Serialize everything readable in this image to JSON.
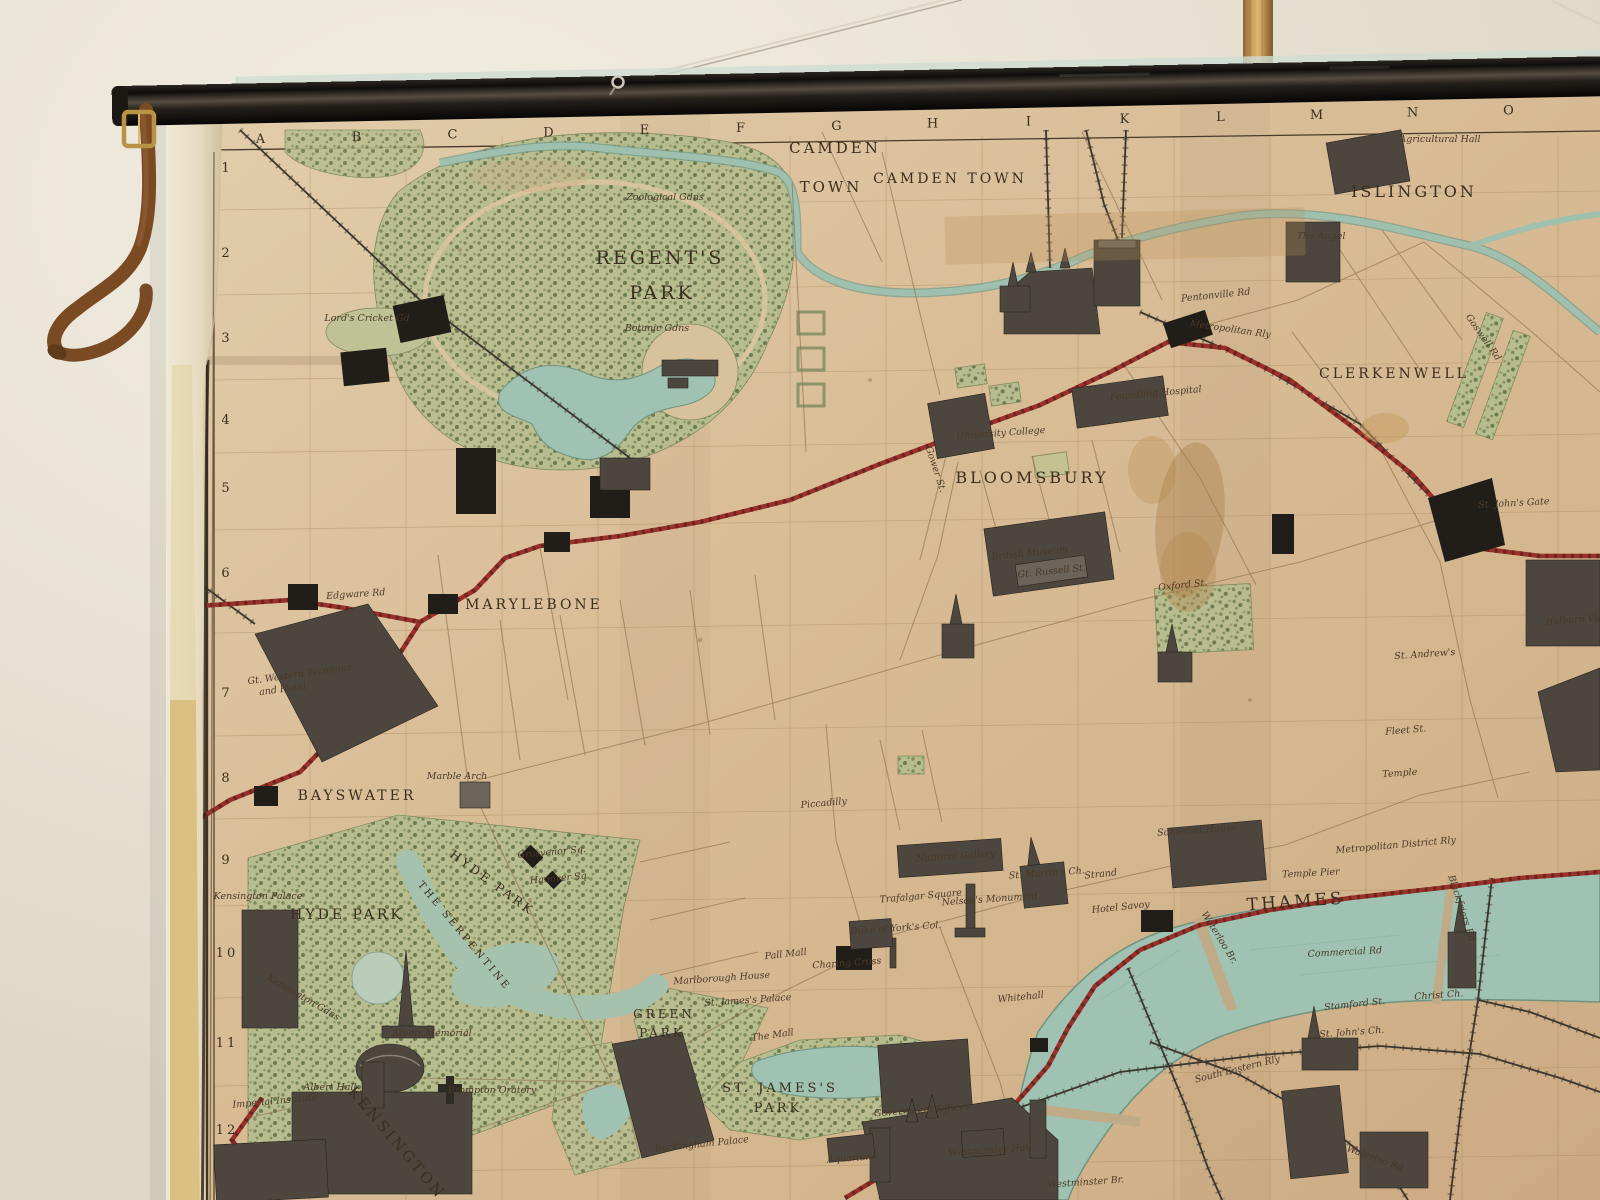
{
  "scene": {
    "description": "Photograph of an antique pictorial wall map of central London hanging from a black roller rod on a plain wall, with a wooden pole and hanging cords at top and a leather strap at the left end",
    "wall_color": "#e9e4d6",
    "roller_color": "#16120f",
    "strap_color": "#7a4a22",
    "pole_color": "#caa05c",
    "paper_color": "#d7bc97",
    "park_color": "#b7bd8f",
    "water_color": "#9fc2b2",
    "railway_red": "#9e2f28",
    "ink_color": "#3a2e1e"
  },
  "map": {
    "grid_letters": [
      "A",
      "B",
      "C",
      "D",
      "E",
      "F",
      "G",
      "H",
      "I",
      "K",
      "L",
      "M",
      "N",
      "O"
    ],
    "grid_rows": [
      "1",
      "2",
      "3",
      "4",
      "5",
      "6",
      "7",
      "8",
      "9",
      "10",
      "11",
      "12"
    ],
    "grid_row_y": [
      172,
      257,
      342,
      424,
      492,
      577,
      697,
      782,
      864,
      957,
      1047,
      1134
    ],
    "labels": [
      {
        "id": "camden-town-1a",
        "t": "CAMDEN",
        "x": 835,
        "y": 153,
        "k": "d",
        "s": 15,
        "ls": 4
      },
      {
        "id": "camden-town-1b",
        "t": "TOWN",
        "x": 831,
        "y": 192,
        "k": "d",
        "s": 15,
        "ls": 4
      },
      {
        "id": "camden-town-2",
        "t": "CAMDEN TOWN",
        "x": 950,
        "y": 183,
        "k": "d",
        "s": 14,
        "ls": 3
      },
      {
        "id": "islington",
        "t": "ISLINGTON",
        "x": 1414,
        "y": 197,
        "k": "d",
        "s": 16,
        "ls": 4
      },
      {
        "id": "clerkenwell",
        "t": "CLERKENWELL",
        "x": 1394,
        "y": 378,
        "k": "d",
        "s": 14,
        "ls": 4
      },
      {
        "id": "regents-park-1",
        "t": "REGENT'S",
        "x": 660,
        "y": 264,
        "k": "d",
        "s": 19,
        "ls": 6
      },
      {
        "id": "regents-park-2",
        "t": "PARK",
        "x": 662,
        "y": 299,
        "k": "d",
        "s": 19,
        "ls": 6
      },
      {
        "id": "bloomsbury",
        "t": "BLOOMSBURY",
        "x": 1032,
        "y": 483,
        "k": "d",
        "s": 16,
        "ls": 3
      },
      {
        "id": "marylebone",
        "t": "MARYLEBONE",
        "x": 534,
        "y": 609,
        "k": "d",
        "s": 14,
        "ls": 4
      },
      {
        "id": "bayswater",
        "t": "BAYSWATER",
        "x": 357,
        "y": 800,
        "k": "d",
        "s": 14,
        "ls": 3
      },
      {
        "id": "hyde-park-1",
        "t": "HYDE PARK",
        "x": 347,
        "y": 919,
        "k": "d",
        "s": 14,
        "ls": 3
      },
      {
        "id": "hyde-park-2",
        "t": "HYDE PARK",
        "x": 490,
        "y": 886,
        "k": "d",
        "s": 12,
        "r": 36,
        "ls": 2
      },
      {
        "id": "the-serpentine",
        "t": "THE SERPENTINE",
        "x": 462,
        "y": 938,
        "k": "d",
        "s": 10,
        "r": 50,
        "ls": 2
      },
      {
        "id": "green-park-1",
        "t": "GREEN",
        "x": 664,
        "y": 1018,
        "k": "d",
        "s": 12,
        "ls": 2
      },
      {
        "id": "green-park-2",
        "t": "PARK",
        "x": 662,
        "y": 1037,
        "k": "d",
        "s": 12,
        "ls": 2
      },
      {
        "id": "st-jamess-park-1",
        "t": "ST. JAMES'S",
        "x": 780,
        "y": 1092,
        "k": "d",
        "s": 13,
        "ls": 2
      },
      {
        "id": "st-jamess-park-2",
        "t": "PARK",
        "x": 778,
        "y": 1112,
        "k": "d",
        "s": 13,
        "ls": 2
      },
      {
        "id": "thames",
        "t": "THAMES",
        "x": 1296,
        "y": 907,
        "k": "d",
        "s": 17,
        "r": -4,
        "ls": 7
      },
      {
        "id": "kensington",
        "t": "KENSINGTON",
        "x": 393,
        "y": 1146,
        "k": "d",
        "s": 15,
        "r": 50,
        "ls": 3
      },
      {
        "id": "zoological-gdns",
        "t": "Zoological Gdns",
        "x": 665,
        "y": 200,
        "k": "i"
      },
      {
        "id": "botanic-gdns",
        "t": "Botanic Gdns",
        "x": 657,
        "y": 331,
        "k": "i"
      },
      {
        "id": "lords-cricket",
        "t": "Lord's Cricket Gd",
        "x": 367,
        "y": 321,
        "k": "i"
      },
      {
        "id": "agricultural-hall",
        "t": "Agricultural Hall",
        "x": 1440,
        "y": 142,
        "k": "i"
      },
      {
        "id": "the-angel",
        "t": "The Angel",
        "x": 1321,
        "y": 239,
        "k": "i"
      },
      {
        "id": "pentonville-rd",
        "t": "Pentonville Rd",
        "x": 1216,
        "y": 298,
        "k": "i",
        "r": -6
      },
      {
        "id": "metropolitan-rly",
        "t": "Metropolitan Rly",
        "x": 1230,
        "y": 332,
        "k": "i",
        "r": 8
      },
      {
        "id": "foundling-hospital",
        "t": "Foundling Hospital",
        "x": 1156,
        "y": 396,
        "k": "i",
        "r": -5
      },
      {
        "id": "university-college",
        "t": "University College",
        "x": 1001,
        "y": 436,
        "k": "i",
        "r": -4
      },
      {
        "id": "british-museum",
        "t": "British Museum",
        "x": 1030,
        "y": 556,
        "k": "i",
        "r": -6
      },
      {
        "id": "gt-russell-st",
        "t": "Gt. Russell St.",
        "x": 1052,
        "y": 574,
        "k": "i",
        "r": -6
      },
      {
        "id": "gt-western-terminus",
        "t": "Gt. Western Terminus",
        "x": 300,
        "y": 677,
        "k": "i",
        "r": -8
      },
      {
        "id": "gt-western-hotel",
        "t": "and Hotel",
        "x": 283,
        "y": 692,
        "k": "i",
        "r": -8
      },
      {
        "id": "edgware-rd",
        "t": "Edgware Rd",
        "x": 356,
        "y": 597,
        "k": "i",
        "r": -4
      },
      {
        "id": "marble-arch",
        "t": "Marble Arch",
        "x": 457,
        "y": 779,
        "k": "i"
      },
      {
        "id": "grosvenor-sq",
        "t": "Grosvenor Sq.",
        "x": 552,
        "y": 855,
        "k": "i",
        "r": -5
      },
      {
        "id": "hanover-sq",
        "t": "Hanover Sq.",
        "x": 560,
        "y": 881,
        "k": "i",
        "r": -5
      },
      {
        "id": "piccadilly",
        "t": "Piccadilly",
        "x": 824,
        "y": 806,
        "k": "i",
        "r": -5
      },
      {
        "id": "kensington-gdns",
        "t": "Kensington Gdns",
        "x": 302,
        "y": 1000,
        "k": "i",
        "r": 30
      },
      {
        "id": "kensington-palace",
        "t": "Kensington Palace",
        "x": 258,
        "y": 899,
        "k": "i"
      },
      {
        "id": "albert-memorial",
        "t": "Albert Memorial",
        "x": 432,
        "y": 1036,
        "k": "i"
      },
      {
        "id": "albert-hall",
        "t": "Albert Hall",
        "x": 330,
        "y": 1090,
        "k": "i"
      },
      {
        "id": "imperial-institute",
        "t": "Imperial Institute",
        "x": 275,
        "y": 1104,
        "k": "i",
        "r": -5
      },
      {
        "id": "brompton-oratory",
        "t": "Brompton Oratory",
        "x": 492,
        "y": 1093,
        "k": "i"
      },
      {
        "id": "buckingham-palace",
        "t": "Buckingham Palace",
        "x": 702,
        "y": 1147,
        "k": "i",
        "r": -6
      },
      {
        "id": "national-gallery",
        "t": "National Gallery",
        "x": 956,
        "y": 859,
        "k": "i",
        "r": -4
      },
      {
        "id": "trafalgar-square",
        "t": "Trafalgar Square",
        "x": 921,
        "y": 899,
        "k": "i",
        "r": -5
      },
      {
        "id": "nelsons-monument",
        "t": "Nelson's Monument",
        "x": 990,
        "y": 902,
        "k": "i",
        "r": -4
      },
      {
        "id": "st-martins-ch",
        "t": "St. Martin's Ch.",
        "x": 1047,
        "y": 876,
        "k": "i",
        "r": -4
      },
      {
        "id": "duke-of-yorks-col",
        "t": "Duke of York's Col.",
        "x": 896,
        "y": 931,
        "k": "i",
        "r": -4
      },
      {
        "id": "pall-mall",
        "t": "Pall Mall",
        "x": 786,
        "y": 957,
        "k": "i",
        "r": -6
      },
      {
        "id": "marlborough-house",
        "t": "Marlborough House",
        "x": 722,
        "y": 981,
        "k": "i",
        "r": -4
      },
      {
        "id": "st-jamess-palace",
        "t": "St. James's Palace",
        "x": 748,
        "y": 1003,
        "k": "i",
        "r": -4
      },
      {
        "id": "the-mall",
        "t": "The Mall",
        "x": 773,
        "y": 1038,
        "k": "i",
        "r": -8
      },
      {
        "id": "charing-cross",
        "t": "Charing Cross",
        "x": 847,
        "y": 966,
        "k": "i",
        "r": -4
      },
      {
        "id": "whitehall",
        "t": "Whitehall",
        "x": 1021,
        "y": 1000,
        "k": "i",
        "r": -6
      },
      {
        "id": "strand",
        "t": "Strand",
        "x": 1101,
        "y": 877,
        "k": "i",
        "r": -6
      },
      {
        "id": "hotel-savoy",
        "t": "Hotel Savoy",
        "x": 1121,
        "y": 910,
        "k": "i",
        "r": -6
      },
      {
        "id": "somerset-house",
        "t": "Somerset House",
        "x": 1197,
        "y": 833,
        "k": "i",
        "r": -4
      },
      {
        "id": "waterloo-br",
        "t": "Waterloo Br.",
        "x": 1217,
        "y": 939,
        "k": "i",
        "r": 58
      },
      {
        "id": "temple-pier",
        "t": "Temple Pier",
        "x": 1311,
        "y": 876,
        "k": "i",
        "r": -3
      },
      {
        "id": "metropolitan-district-rly",
        "t": "Metropolitan District Rly",
        "x": 1396,
        "y": 848,
        "k": "i",
        "r": -5
      },
      {
        "id": "blackfriars-rd",
        "t": "Blackfriars Rd",
        "x": 1459,
        "y": 909,
        "k": "i",
        "r": 72
      },
      {
        "id": "commercial-rd",
        "t": "Commercial Rd",
        "x": 1345,
        "y": 955,
        "k": "i",
        "r": -3
      },
      {
        "id": "stamford-st",
        "t": "Stamford St.",
        "x": 1355,
        "y": 1007,
        "k": "i",
        "r": -6
      },
      {
        "id": "st-johns-ch",
        "t": "St. John's Ch.",
        "x": 1352,
        "y": 1035,
        "k": "i",
        "r": -4
      },
      {
        "id": "christ-ch",
        "t": "Christ Ch.",
        "x": 1439,
        "y": 998,
        "k": "i",
        "r": -4
      },
      {
        "id": "south-eastern-rly",
        "t": "South Eastern Rly",
        "x": 1238,
        "y": 1072,
        "k": "i",
        "r": -14
      },
      {
        "id": "waterloo-rd",
        "t": "Waterloo Rd",
        "x": 1374,
        "y": 1161,
        "k": "i",
        "r": 20
      },
      {
        "id": "westminster-hall",
        "t": "Westminster Hall",
        "x": 990,
        "y": 1153,
        "k": "i",
        "r": -4
      },
      {
        "id": "government-offices",
        "t": "Government Offices",
        "x": 922,
        "y": 1113,
        "k": "i",
        "r": -4
      },
      {
        "id": "aquarium",
        "t": "Aquarium",
        "x": 851,
        "y": 1161,
        "k": "i",
        "r": -4
      },
      {
        "id": "westminster-br",
        "t": "Westminster Br.",
        "x": 1086,
        "y": 1185,
        "k": "i",
        "r": -4
      },
      {
        "id": "st-johns-gate",
        "t": "St. John's Gate",
        "x": 1514,
        "y": 506,
        "k": "i",
        "r": -3
      },
      {
        "id": "st-andrews",
        "t": "St. Andrew's",
        "x": 1425,
        "y": 657,
        "k": "i",
        "r": -4
      },
      {
        "id": "holborn-viaduct",
        "t": "Holborn Viaduct",
        "x": 1585,
        "y": 622,
        "k": "i",
        "r": -4
      },
      {
        "id": "fleet-st",
        "t": "Fleet St.",
        "x": 1406,
        "y": 733,
        "k": "i",
        "r": -5
      },
      {
        "id": "temple",
        "t": "Temple",
        "x": 1400,
        "y": 776,
        "k": "i",
        "r": -4
      },
      {
        "id": "goswell-rd",
        "t": "Goswell Rd",
        "x": 1481,
        "y": 339,
        "k": "i",
        "r": 55
      },
      {
        "id": "oxford-st",
        "t": "Oxford St.",
        "x": 1183,
        "y": 588,
        "k": "i",
        "r": -6
      },
      {
        "id": "gower-st",
        "t": "Gower St.",
        "x": 933,
        "y": 470,
        "k": "i",
        "r": 72
      }
    ]
  }
}
